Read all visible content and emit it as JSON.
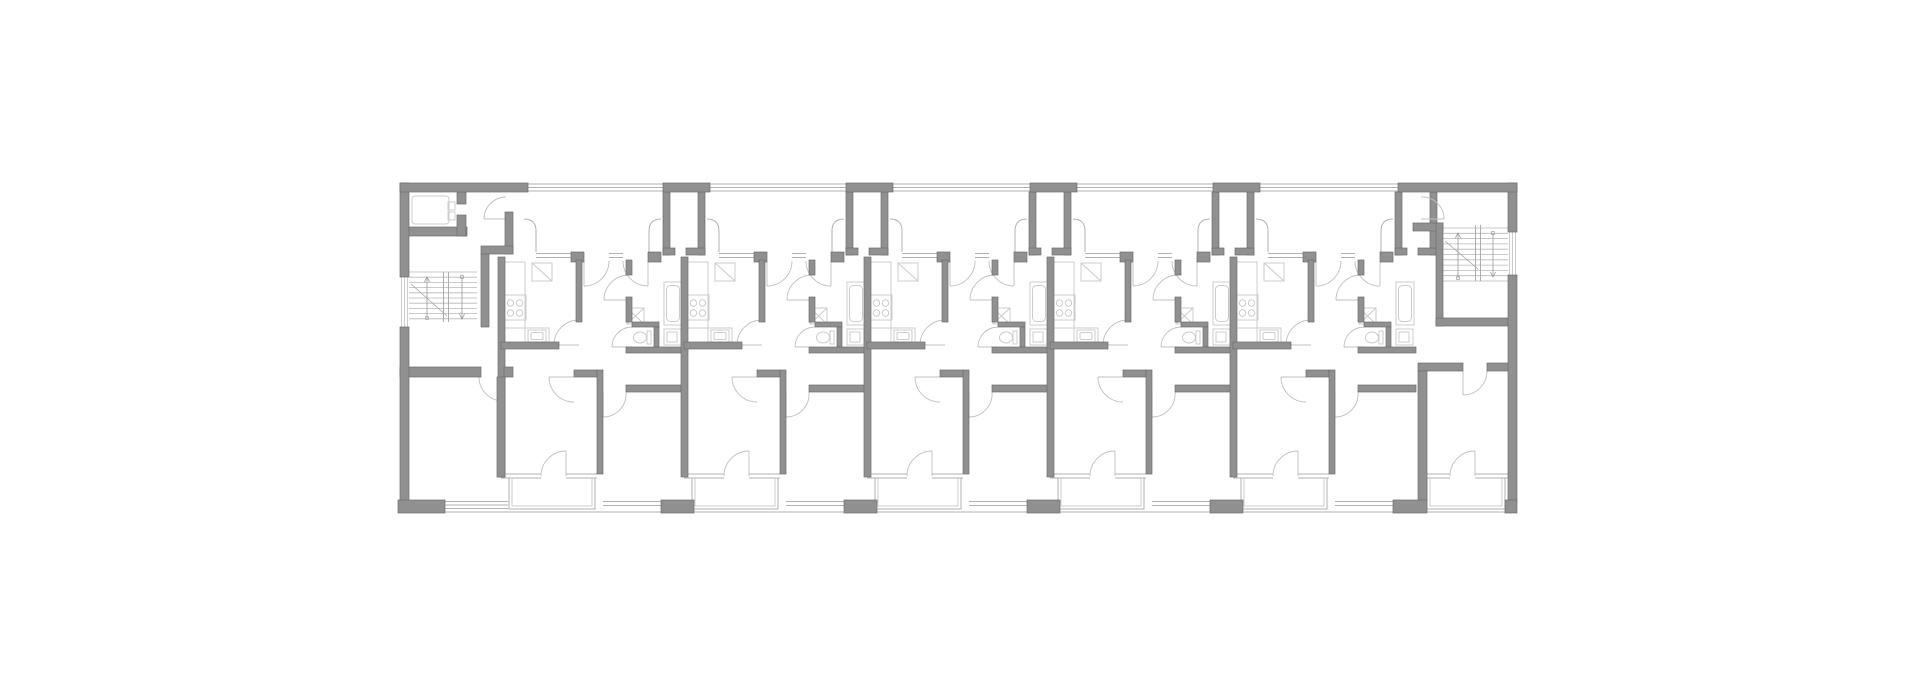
{
  "meta": {
    "description": "Architectural floor plan of a linear multi-unit residential building, no text labels visible",
    "canvas": {
      "width": 1920,
      "height": 678
    }
  },
  "palette": {
    "bg": "#ffffff",
    "wall": "#909090",
    "wallEdge": "#6e6e6e",
    "thin": "#b2b2b2",
    "light": "#cccccc",
    "door": "#c0c0c0",
    "stair": "#b8b8b8",
    "rail": "#a6a6a6",
    "arrow": "#9a9a9a"
  },
  "building": {
    "left": 400,
    "top": 183,
    "right": 1517,
    "bottom": 513
  },
  "moduleOrigins": [
    501,
    684,
    867,
    1050,
    1233
  ],
  "exterior": {
    "topPiers": [
      [
        400,
        183,
        128,
        9
      ],
      [
        663,
        183,
        47,
        9
      ],
      [
        846,
        183,
        47,
        9
      ],
      [
        1030,
        183,
        47,
        9
      ],
      [
        1213,
        183,
        47,
        9
      ],
      [
        1398,
        183,
        119,
        9
      ]
    ],
    "bottomPiers": [
      [
        398,
        500,
        47,
        13
      ],
      [
        661,
        500,
        33,
        13
      ],
      [
        844,
        500,
        33,
        13
      ],
      [
        1027,
        500,
        33,
        13
      ],
      [
        1210,
        500,
        33,
        13
      ],
      [
        1393,
        500,
        34,
        13
      ],
      [
        1505,
        500,
        12,
        13
      ]
    ],
    "leftWall": [
      [
        400,
        183,
        9,
        94
      ],
      [
        400,
        327,
        9,
        176
      ]
    ],
    "rightWall": [
      [
        1508,
        183,
        9,
        49
      ],
      [
        1508,
        275,
        9,
        228
      ]
    ],
    "topGlass": [
      [
        400,
        184,
        1517,
        184
      ],
      [
        400,
        187.5,
        1517,
        187.5
      ],
      [
        400,
        191,
        1517,
        191
      ]
    ],
    "bottomLine": [
      398,
      512,
      1517,
      512
    ],
    "leftWindow": [
      [
        401.5,
        277,
        401.5,
        327
      ],
      [
        404.5,
        277,
        404.5,
        327
      ],
      [
        407.5,
        277,
        407.5,
        327
      ]
    ],
    "rightWindow": [
      [
        1509.5,
        232,
        1509.5,
        275
      ],
      [
        1512.5,
        232,
        1512.5,
        275
      ],
      [
        1515.5,
        232,
        1515.5,
        275
      ]
    ],
    "swWindow": [
      [
        445,
        501.5,
        508,
        501.5
      ],
      [
        445,
        505,
        508,
        505
      ],
      [
        445,
        508.5,
        508,
        508.5
      ]
    ]
  },
  "shafts": {
    "at": [
      684,
      867,
      1050,
      1233,
      1416
    ],
    "rects": [
      [
        -21,
        192,
        7,
        63
      ],
      [
        14,
        192,
        7,
        63
      ],
      [
        -21,
        248,
        12,
        7
      ],
      [
        2,
        248,
        19,
        7
      ]
    ]
  },
  "module": {
    "walls": [
      [
        -3,
        257,
        7,
        220
      ],
      [
        70,
        252,
        13,
        10
      ],
      [
        147,
        252,
        13,
        10
      ],
      [
        75,
        260,
        6,
        62
      ],
      [
        0,
        342,
        58,
        7
      ],
      [
        73,
        370,
        23,
        7
      ],
      [
        125,
        260,
        6,
        15
      ],
      [
        125,
        297,
        6,
        25
      ],
      [
        131,
        322,
        27,
        5
      ],
      [
        153,
        327,
        5,
        20
      ],
      [
        125,
        347,
        58,
        6
      ],
      [
        96,
        370,
        6,
        104
      ],
      [
        125,
        385,
        58,
        7
      ]
    ],
    "thin": [
      [
        35,
        253.5,
        70,
        253.5
      ],
      [
        35,
        257.5,
        70,
        257.5
      ],
      [
        108,
        253.5,
        122,
        253.5
      ],
      [
        108,
        257.5,
        122,
        257.5
      ],
      [
        35,
        231,
        35,
        252
      ],
      [
        148,
        231,
        148,
        252
      ],
      [
        0,
        474,
        40,
        474
      ],
      [
        0,
        478,
        40,
        478
      ],
      [
        65,
        474,
        96,
        474
      ],
      [
        65,
        478,
        96,
        478
      ],
      [
        102,
        501.5,
        160,
        501.5
      ],
      [
        102,
        505.5,
        160,
        505.5
      ]
    ],
    "nicheCorners": [
      [
        23,
        219,
        35,
        219,
        35,
        231
      ],
      [
        148,
        231,
        148,
        219,
        160,
        219
      ]
    ],
    "doors": [
      [
        108,
        261,
        83,
        286,
        83,
        261,
        1
      ],
      [
        122,
        261,
        147,
        286,
        147,
        261,
        0
      ],
      [
        78,
        320,
        53,
        345,
        78,
        345,
        0
      ],
      [
        128,
        275,
        103,
        300,
        128,
        300,
        0
      ],
      [
        131,
        327,
        111,
        347,
        131,
        347,
        0
      ],
      [
        73,
        402,
        48,
        377,
        73,
        377,
        1
      ],
      [
        125,
        392,
        102,
        417,
        102,
        392,
        1
      ],
      [
        40,
        476,
        65,
        451,
        65,
        476,
        1
      ]
    ],
    "loggia": {
      "outer": [
        8,
        478,
        94,
        509
      ],
      "inner": [
        11,
        478,
        91,
        506
      ]
    },
    "fixtures": {
      "counters": [
        [
          2,
          262,
          22,
          82
        ],
        [
          2,
          328,
          46,
          16
        ]
      ],
      "hob": [
        3,
        295,
        22,
        25
      ],
      "burners": [
        [
          9.5,
          303
        ],
        [
          18.5,
          303
        ],
        [
          9.5,
          313
        ],
        [
          18.5,
          313
        ]
      ],
      "burnerR": 3.2,
      "sink": [
        27,
        330,
        18,
        12
      ],
      "sinkInner": [
        30,
        332.5,
        12,
        7
      ],
      "fridge": [
        31,
        263,
        20,
        18
      ],
      "tub": [
        163,
        282,
        18,
        43
      ],
      "tubInner": [
        165.5,
        285.5,
        13,
        36
      ],
      "basin": [
        126,
        308,
        17,
        16
      ],
      "toiletTank": [
        146,
        331,
        4,
        13
      ],
      "toiletBowl": [
        139,
        337.5,
        6.5,
        5.5
      ],
      "closet": [
        163,
        329,
        17,
        16
      ],
      "closetInner": [
        166,
        332,
        10,
        10
      ]
    }
  },
  "leftCore": {
    "walls": [
      [
        407,
        227,
        60,
        9
      ],
      [
        457,
        192,
        9,
        12
      ],
      [
        457,
        215,
        9,
        21
      ],
      [
        505,
        212,
        8,
        42
      ],
      [
        481,
        246,
        32,
        8
      ],
      [
        481,
        254,
        8,
        73
      ],
      [
        400,
        367,
        81,
        10
      ],
      [
        504,
        367,
        9,
        10
      ],
      [
        497,
        377,
        8,
        100
      ]
    ],
    "elevator": {
      "car": [
        412,
        196,
        37,
        28
      ],
      "doors": [
        [
          448,
          202,
          7,
          8
        ],
        [
          448,
          212,
          7,
          8
        ]
      ]
    },
    "stair": {
      "treads": {
        "x1": 409,
        "x2": 477,
        "y0": 272,
        "dy": 5.2,
        "n": 10
      },
      "rail": [
        [
          443.5,
          272,
          443.5,
          322
        ],
        [
          448.5,
          272,
          448.5,
          322
        ]
      ],
      "cut": [
        411,
        284,
        447,
        316
      ],
      "arrows": [
        [
          427,
          318,
          427,
          277
        ],
        [
          462,
          277,
          462,
          319
        ]
      ]
    },
    "doors": [
      [
        506,
        197,
        484,
        219,
        506,
        219,
        0
      ],
      [
        479,
        377,
        503,
        401,
        503,
        377,
        0
      ]
    ]
  },
  "rightCore": {
    "walls": [
      [
        1413,
        223,
        30,
        8
      ],
      [
        1436,
        223,
        7,
        103
      ],
      [
        1436,
        318,
        74,
        8
      ],
      [
        1418,
        363,
        45,
        8
      ],
      [
        1487,
        363,
        23,
        8
      ],
      [
        1418,
        371,
        9,
        131
      ]
    ],
    "stair": {
      "treads": {
        "x1": 1443,
        "x2": 1508,
        "y0": 228,
        "dy": 5.3,
        "n": 11
      },
      "rail": [
        [
          1475.5,
          225,
          1475.5,
          281
        ],
        [
          1480.5,
          225,
          1480.5,
          281
        ]
      ],
      "cut": [
        1445,
        241,
        1478,
        269
      ],
      "arrows": [
        [
          1458,
          278,
          1458,
          233
        ],
        [
          1493,
          233,
          1493,
          277
        ]
      ]
    },
    "doors": [
      [
        1421,
        197,
        1444,
        219,
        1421,
        219,
        1
      ],
      [
        1487,
        371,
        1463,
        395,
        1463,
        371,
        1
      ],
      [
        1450,
        476,
        1475,
        451,
        1475,
        476,
        1
      ]
    ],
    "thin": [
      [
        1427,
        474,
        1450,
        474
      ],
      [
        1427,
        478,
        1450,
        478
      ],
      [
        1475,
        474,
        1508,
        474
      ],
      [
        1475,
        478,
        1508,
        478
      ]
    ],
    "loggia": {
      "outer": [
        1427,
        478,
        1505,
        509
      ],
      "inner": [
        1430,
        478,
        1502,
        506
      ]
    }
  }
}
